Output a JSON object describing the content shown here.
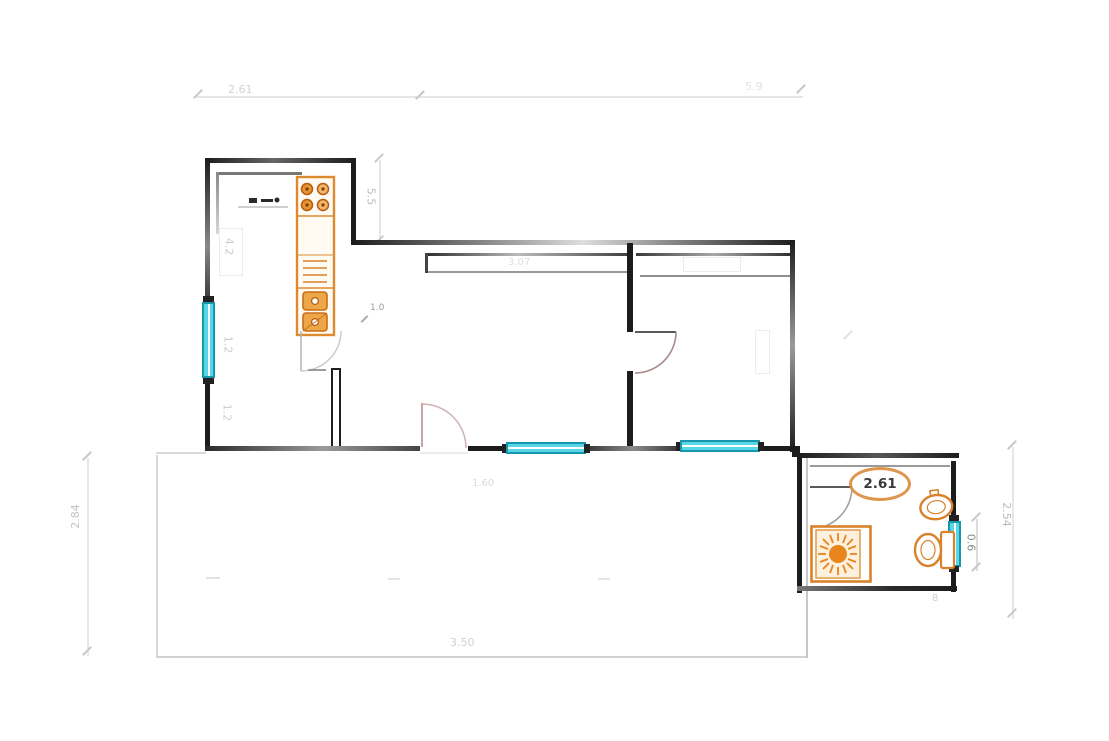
{
  "colors": {
    "wall": "#1c1c1c",
    "window_fill": "#57d6e8",
    "window_frame": "#1697ab",
    "fixture": "#d9822b",
    "fixture_dark": "#b35b13",
    "dim_line": "#e6e6e6",
    "label_faint": "#c6c6c6"
  },
  "labels": {
    "top_left": "2.61",
    "top_right": "5.9",
    "kitchen_side": "5.5",
    "left_side": "2.84",
    "right_side": "2.54",
    "bath_width": "2.61",
    "bath_window": "0.6",
    "living_wall": "3.07",
    "living_floor": "1.60",
    "terrace": "3.50",
    "kitchen_a": "4.2",
    "kitchen_b": "1.2",
    "kitchen_c": "1.2",
    "hall": "1.0",
    "bath_mark": "8"
  },
  "fixtures": {
    "stove": "stove-icon",
    "kitchen_sink": "double-sink-icon",
    "faucet": "faucet-icon",
    "shower": "shower-icon",
    "toilet": "toilet-icon",
    "basin": "wash-basin-icon"
  }
}
